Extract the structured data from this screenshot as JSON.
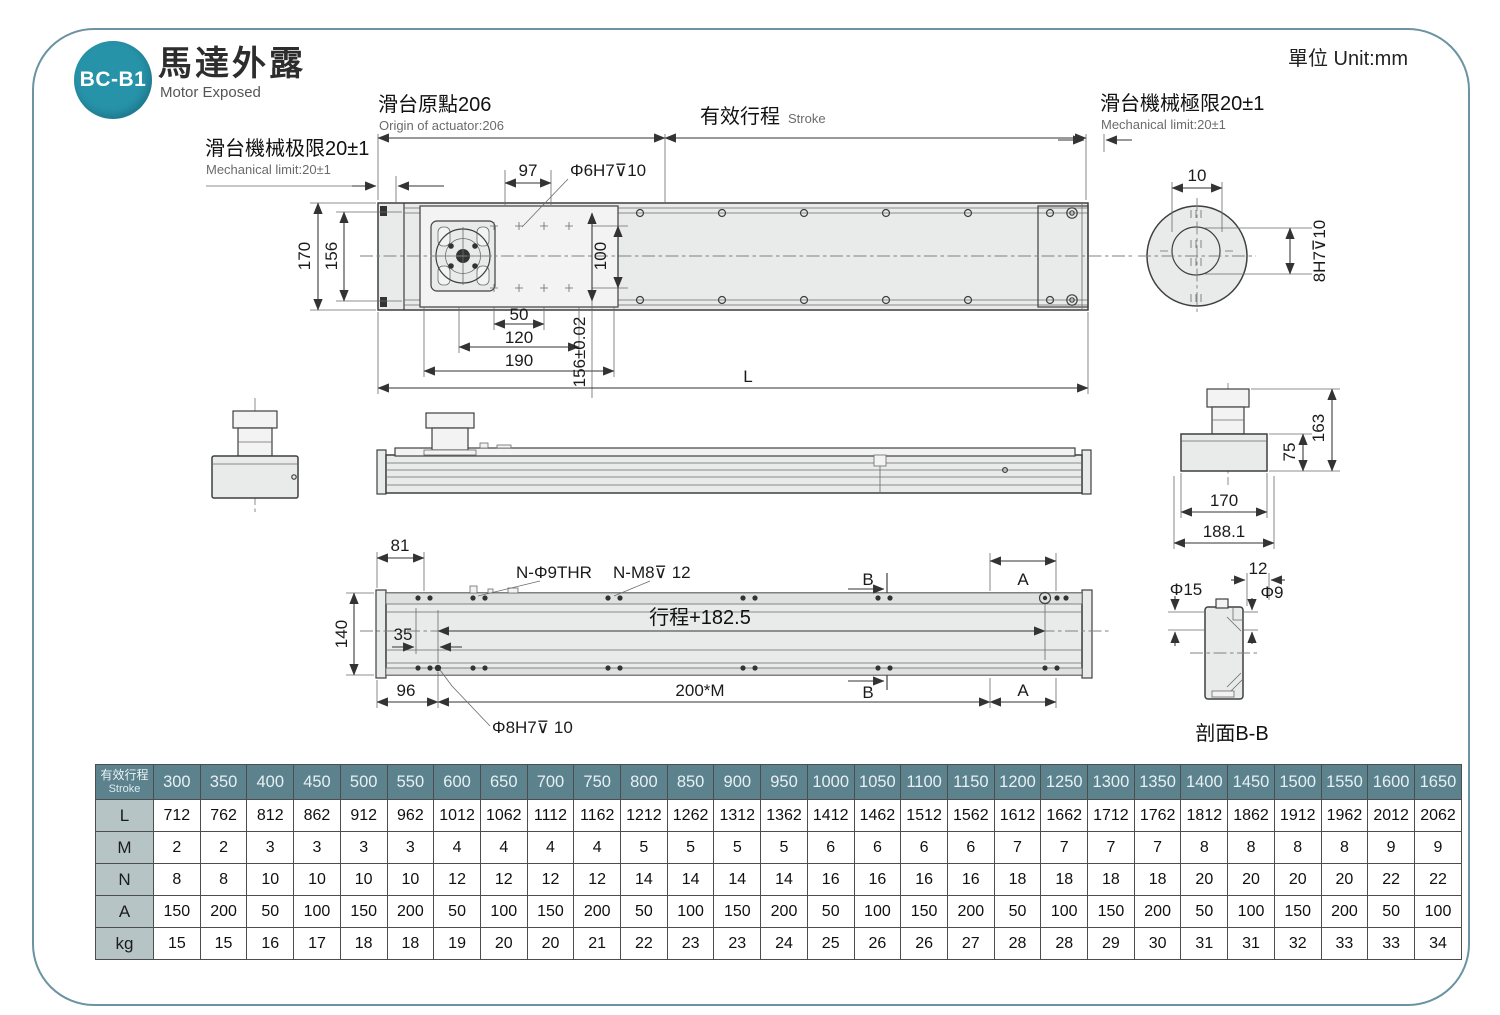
{
  "page": {
    "badge": "BC-B1",
    "title_zh": "馬達外露",
    "title_en": "Motor Exposed",
    "unit_label": "單位 Unit:mm"
  },
  "colors": {
    "badge_teal": "#2793a9",
    "frame_border": "#6b93a1",
    "table_header_bg": "#5c828e",
    "table_rowlabel_bg": "#b7c4c6",
    "drawing_fill": "#e9ebea"
  },
  "annotations": {
    "origin_zh": "滑台原點206",
    "origin_en": "Origin of actuator:206",
    "stroke_zh": "有效行程",
    "stroke_en": "Stroke",
    "mech_left_zh": "滑台機械极限20±1",
    "mech_left_en": "Mechanical limit:20±1",
    "mech_right_zh": "滑台機械極限20±1",
    "mech_right_en": "Mechanical limit:20±1",
    "dim_97": "97",
    "hole_top": "Φ6H7⊽10",
    "dim_170": "170",
    "dim_156": "156",
    "dim_100": "100",
    "dim_50": "50",
    "dim_120": "120",
    "dim_190": "190",
    "dim_156_tol": "156±0.02",
    "dim_L": "L",
    "dim_10": "10",
    "shaft_bore": "8H7⊽10",
    "dim_163": "163",
    "dim_75": "75",
    "dim_170_end": "170",
    "dim_188_1": "188.1",
    "dim_81": "81",
    "hole_thr": "N-Φ9THR",
    "hole_m8": "N-M8⊽ 12",
    "mark_B": "B",
    "mark_A": "A",
    "dim_140": "140",
    "dim_35": "35",
    "stroke_plus": "行程+182.5",
    "dim_96": "96",
    "dim_200m": "200*M",
    "hole_dowel": "Φ8H7⊽ 10",
    "dim_phi15": "Φ15",
    "dim_12": "12",
    "dim_phi9": "Φ9",
    "section_label": "剖面B-B"
  },
  "table": {
    "header_label_zh": "有效行程",
    "header_label_en": "Stroke",
    "strokes": [
      300,
      350,
      400,
      450,
      500,
      550,
      600,
      650,
      700,
      750,
      800,
      850,
      900,
      950,
      1000,
      1050,
      1100,
      1150,
      1200,
      1250,
      1300,
      1350,
      1400,
      1450,
      1500,
      1550,
      1600,
      1650
    ],
    "rows": [
      {
        "label": "L",
        "values": [
          712,
          762,
          812,
          862,
          912,
          962,
          1012,
          1062,
          1112,
          1162,
          1212,
          1262,
          1312,
          1362,
          1412,
          1462,
          1512,
          1562,
          1612,
          1662,
          1712,
          1762,
          1812,
          1862,
          1912,
          1962,
          2012,
          2062
        ]
      },
      {
        "label": "M",
        "values": [
          2,
          2,
          3,
          3,
          3,
          3,
          4,
          4,
          4,
          4,
          5,
          5,
          5,
          5,
          6,
          6,
          6,
          6,
          7,
          7,
          7,
          7,
          8,
          8,
          8,
          8,
          9,
          9
        ]
      },
      {
        "label": "N",
        "values": [
          8,
          8,
          10,
          10,
          10,
          10,
          12,
          12,
          12,
          12,
          14,
          14,
          14,
          14,
          16,
          16,
          16,
          16,
          18,
          18,
          18,
          18,
          20,
          20,
          20,
          20,
          22,
          22
        ]
      },
      {
        "label": "A",
        "values": [
          150,
          200,
          50,
          100,
          150,
          200,
          50,
          100,
          150,
          200,
          50,
          100,
          150,
          200,
          50,
          100,
          150,
          200,
          50,
          100,
          150,
          200,
          50,
          100,
          150,
          200,
          50,
          100
        ]
      },
      {
        "label": "kg",
        "values": [
          15,
          15,
          16,
          17,
          18,
          18,
          19,
          20,
          20,
          21,
          22,
          23,
          23,
          24,
          25,
          26,
          26,
          27,
          28,
          28,
          29,
          30,
          31,
          31,
          32,
          33,
          33,
          34
        ]
      }
    ]
  }
}
